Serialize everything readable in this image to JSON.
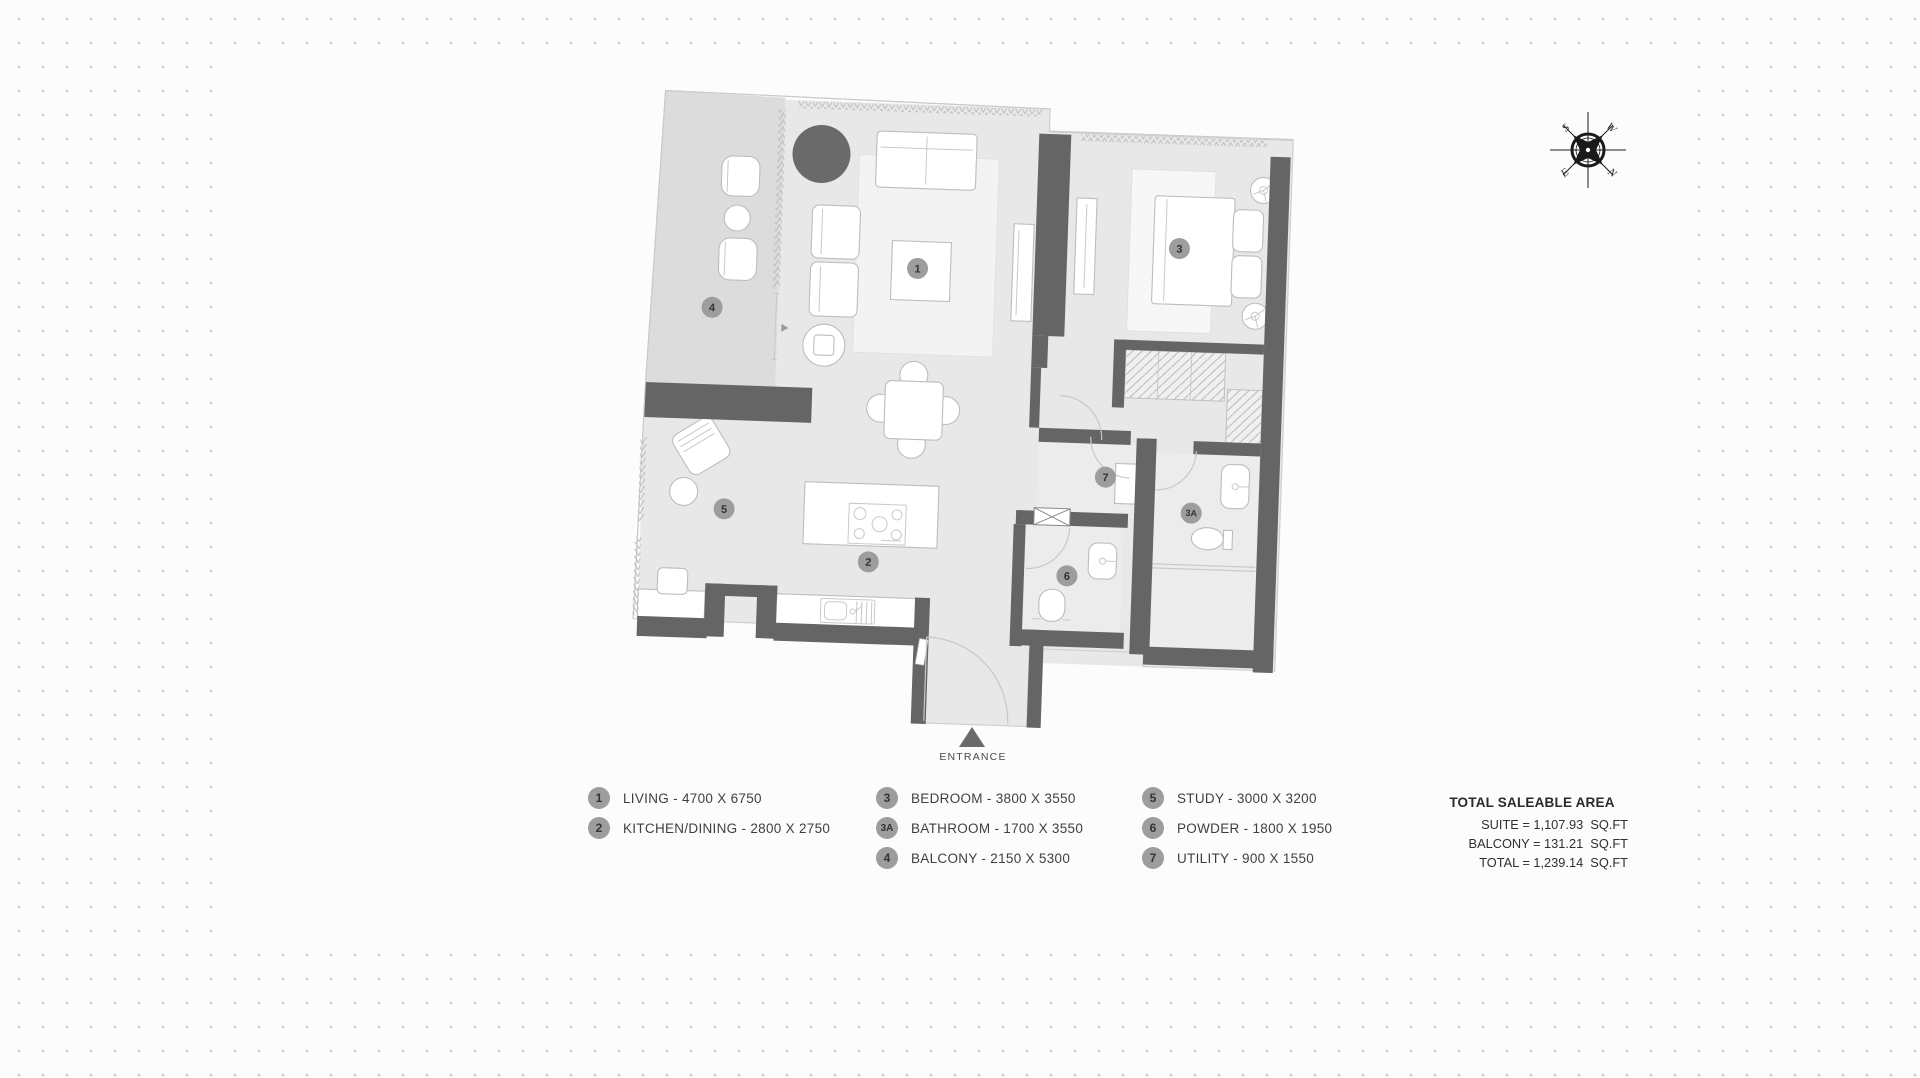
{
  "colors": {
    "wall": "#656565",
    "floor": "#e8e8e8",
    "balcony_floor": "#dcdcdc",
    "marker": "#9d9d9d",
    "background_dot": "#c9c9c9"
  },
  "plan": {
    "entrance_label": "ENTRANCE",
    "markers": [
      {
        "id": "1"
      },
      {
        "id": "2"
      },
      {
        "id": "3"
      },
      {
        "id": "3A"
      },
      {
        "id": "4"
      },
      {
        "id": "5"
      },
      {
        "id": "6"
      },
      {
        "id": "7"
      }
    ]
  },
  "compass": {
    "labels": {
      "n": "N",
      "s": "S",
      "e": "E",
      "w": "W"
    }
  },
  "legend": {
    "columns": [
      {
        "items": [
          {
            "num": "1",
            "label": "LIVING - 4700 X 6750"
          },
          {
            "num": "2",
            "label": "KITCHEN/DINING - 2800 X 2750"
          }
        ]
      },
      {
        "items": [
          {
            "num": "3",
            "label": "BEDROOM - 3800 X 3550"
          },
          {
            "num": "3A",
            "label": "BATHROOM - 1700 X 3550"
          },
          {
            "num": "4",
            "label": "BALCONY - 2150 X 5300"
          }
        ]
      },
      {
        "items": [
          {
            "num": "5",
            "label": "STUDY - 3000 X 3200"
          },
          {
            "num": "6",
            "label": "POWDER - 1800 X 1950"
          },
          {
            "num": "7",
            "label": "UTILITY - 900 X 1550"
          }
        ]
      }
    ]
  },
  "totals": {
    "title": "TOTAL SALEABLE AREA",
    "lines": [
      "SUITE = 1,107.93  SQ.FT",
      "BALCONY = 131.21  SQ.FT",
      "TOTAL = 1,239.14  SQ.FT"
    ]
  }
}
